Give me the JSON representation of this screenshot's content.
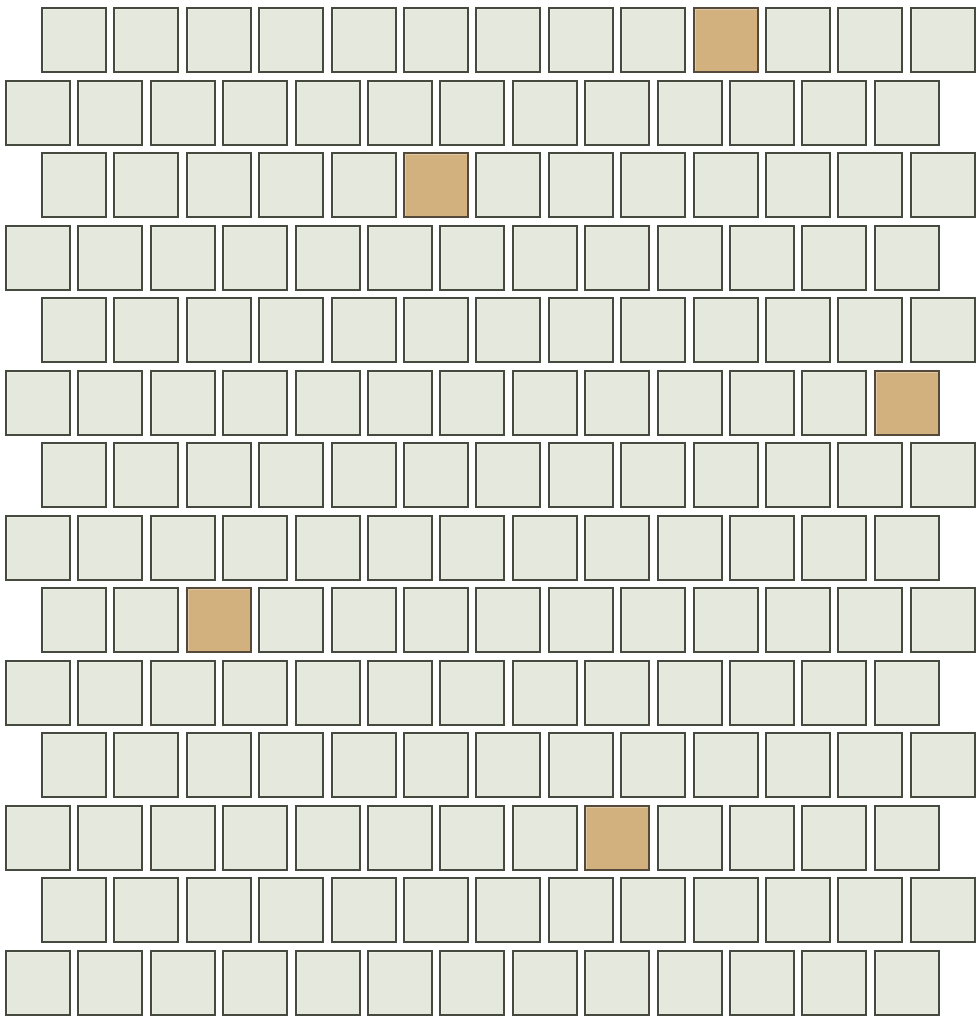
{
  "mosaic": {
    "description": "offset brick-pattern square tile mosaic sheet, white tiles with scattered tan accent tiles",
    "rows": 14,
    "columns": 13,
    "tile_size": 66,
    "h_pitch": 72.4,
    "v_pitch": 72.5,
    "top_offset": 7,
    "odd_row_left": 41,
    "even_row_left": 5,
    "accent_tiles": [
      {
        "row": 1,
        "col": 10
      },
      {
        "row": 3,
        "col": 6
      },
      {
        "row": 6,
        "col": 13
      },
      {
        "row": 9,
        "col": 3
      },
      {
        "row": 12,
        "col": 9
      }
    ],
    "colors": {
      "background": "#ffffff",
      "tile_fill": "#e5e8dd",
      "tile_border": "#454a3f",
      "accent_fill": "#d2b17e",
      "accent_border": "#55493a"
    }
  }
}
